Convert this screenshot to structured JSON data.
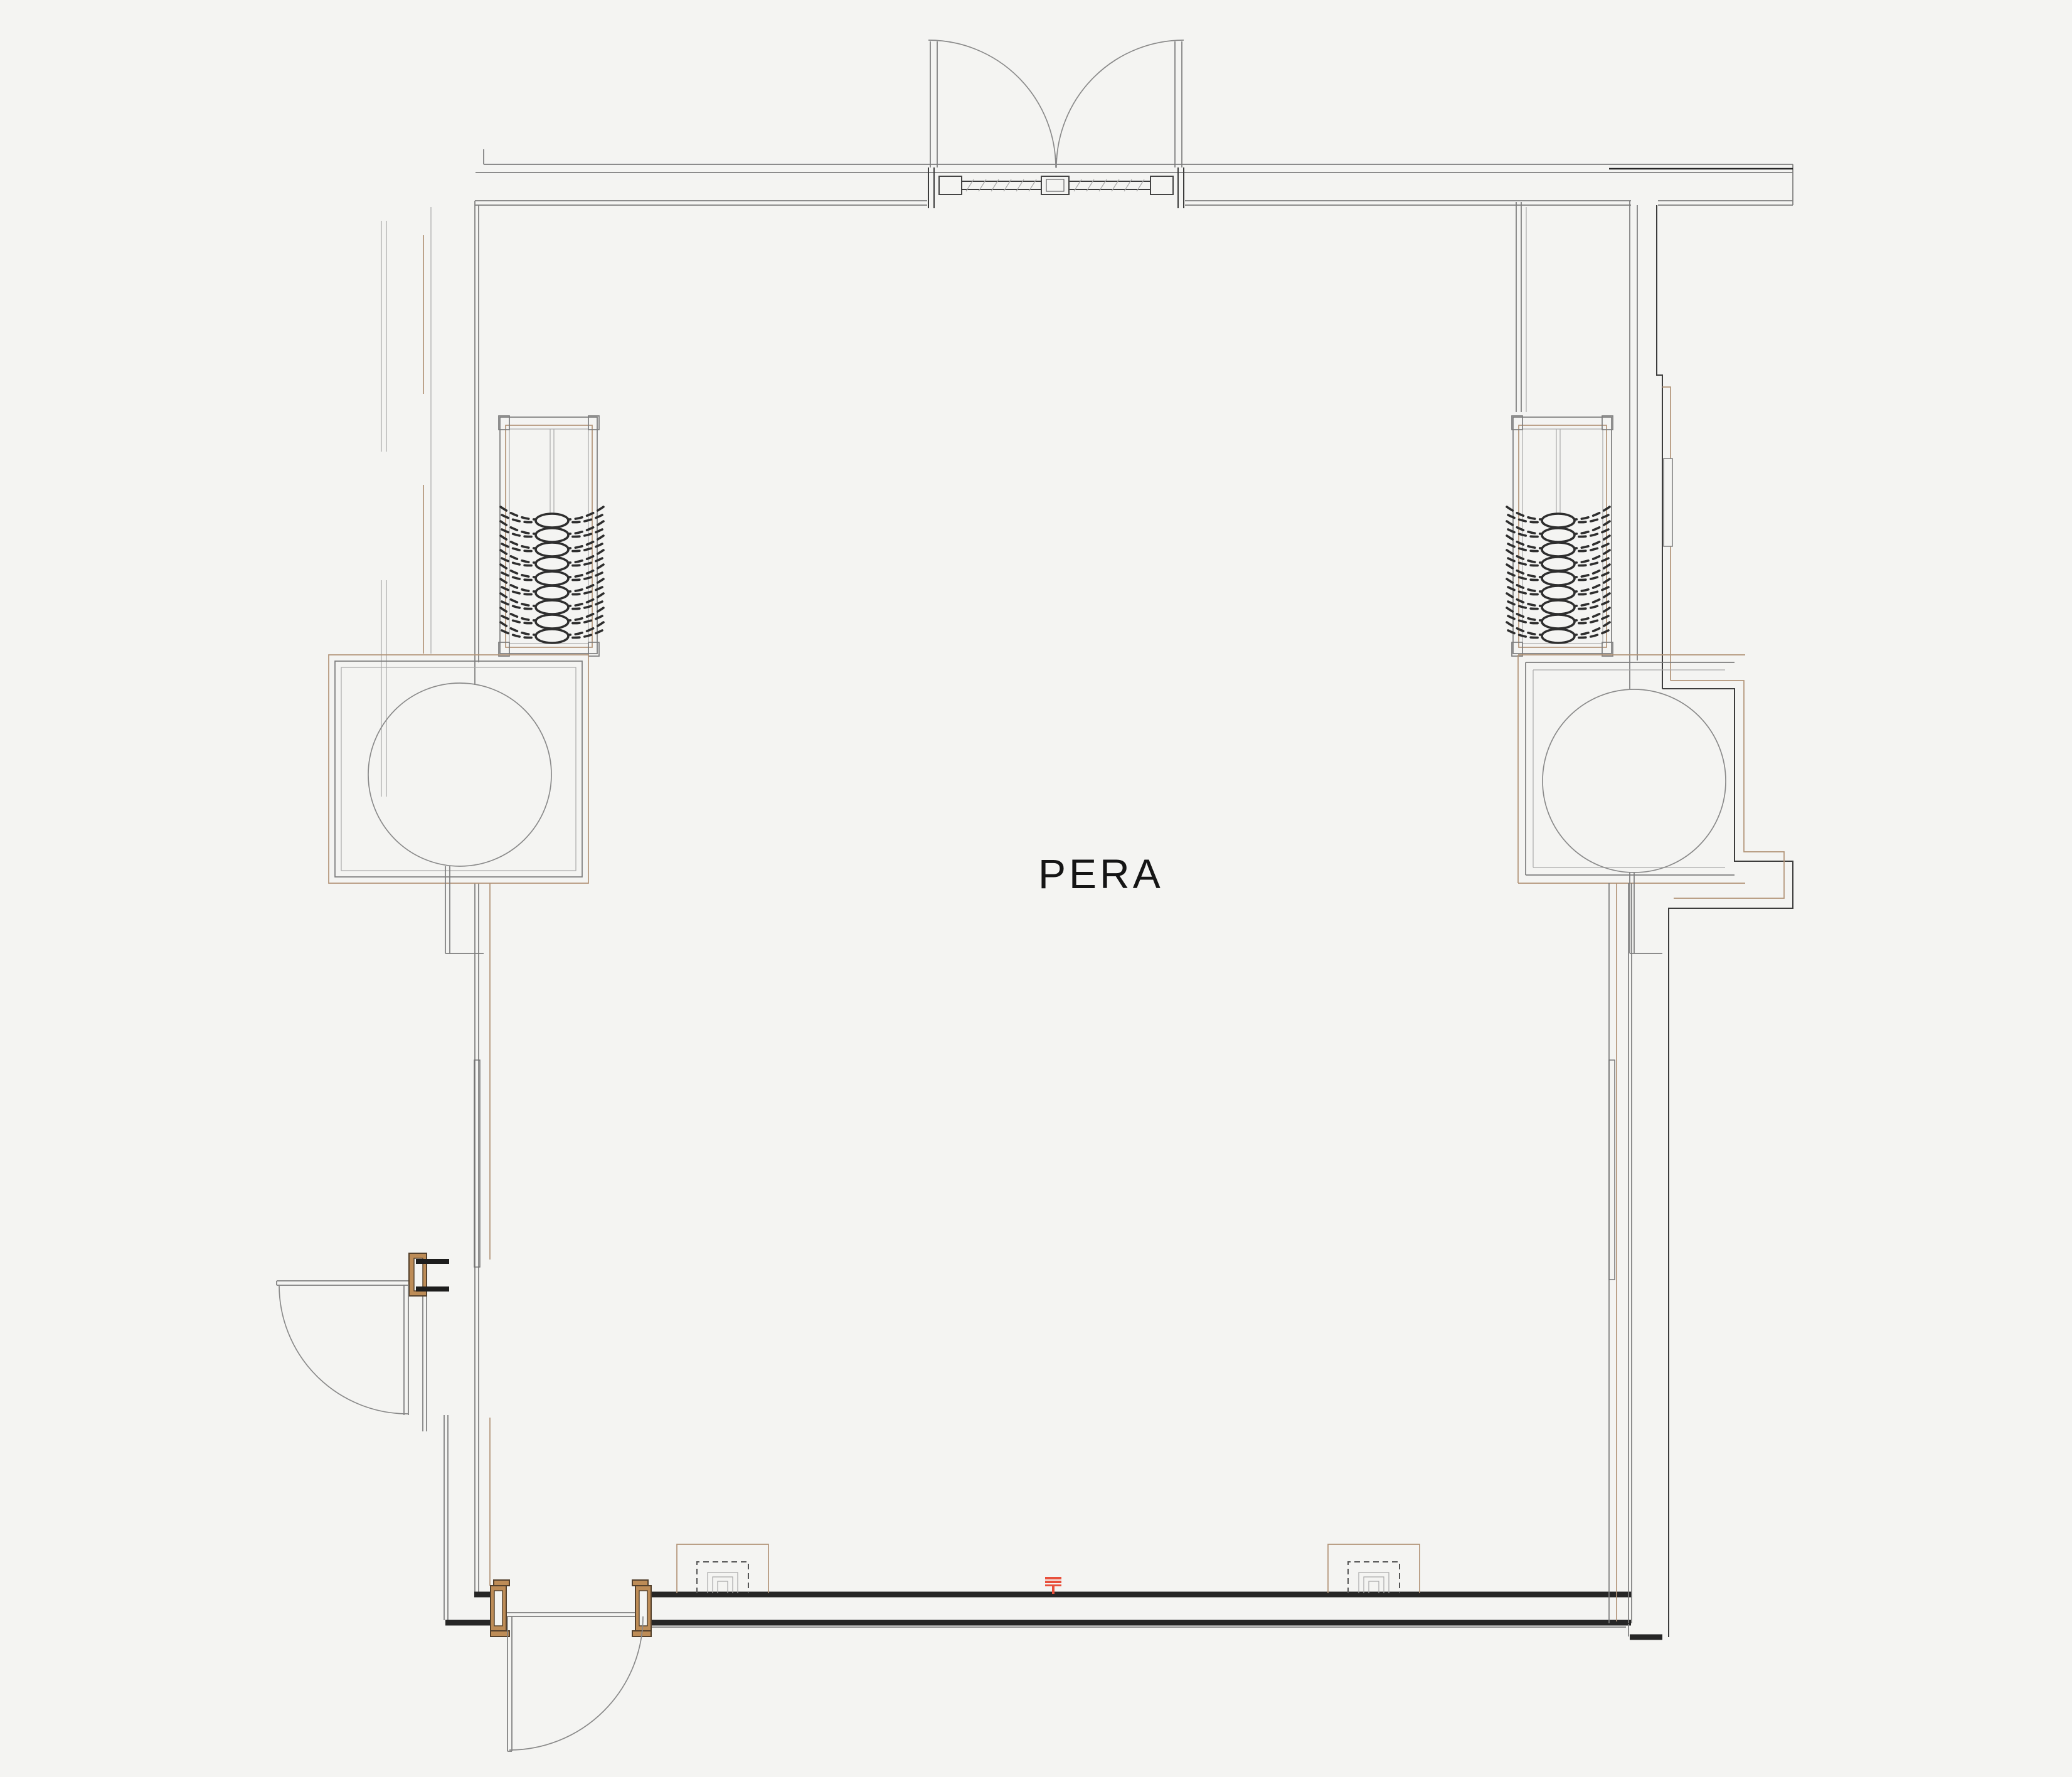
{
  "room_label": "PERA",
  "palette": {
    "background": "#f4f4f2",
    "wall_line": "#7d7d7d",
    "wall_dark": "#262626",
    "trim_tan": "#b29478",
    "door_frame_fill": "#bd8c57",
    "door_frame_edge": "#53402c",
    "hanger_dark": "#2e2e2e",
    "marker_red": "#e8503c",
    "label_text": "#151515"
  },
  "elements": {
    "entry_door_type": "double-swing",
    "side_doors": 2,
    "coat_racks": 2,
    "hangers_per_rack": 9,
    "round_columns": 2,
    "floor_boxes": 2,
    "survey_markers": 1
  }
}
